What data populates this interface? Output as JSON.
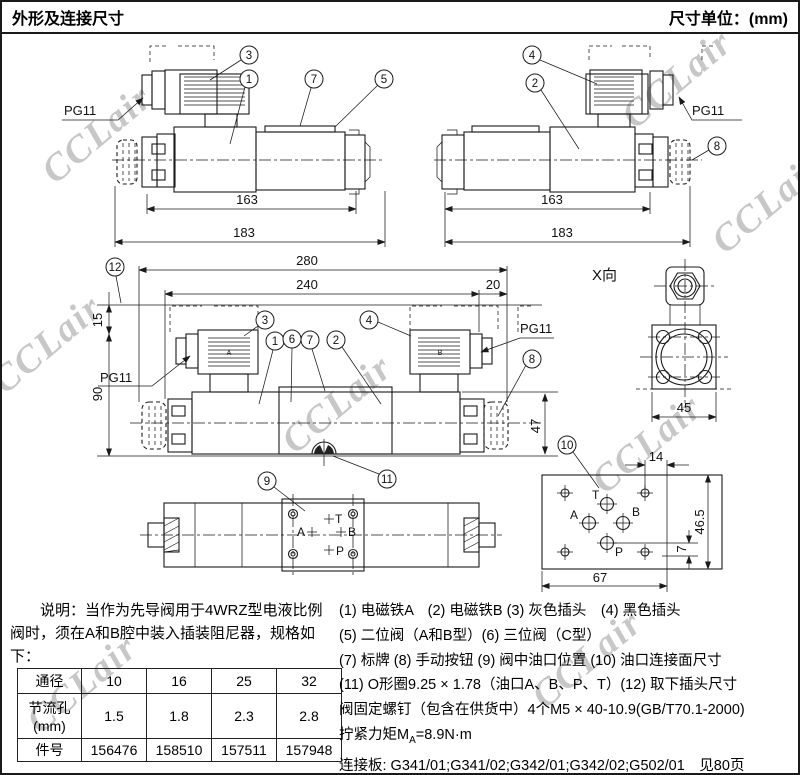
{
  "header": {
    "title": "外形及连接尺寸",
    "unit_label": "尺寸单位：(mm)"
  },
  "watermark": {
    "text": "CCLair"
  },
  "drawing": {
    "pg11": "PG11",
    "x_view_label": "X向",
    "callouts": {
      "c1": "1",
      "c2": "2",
      "c3": "3",
      "c4": "4",
      "c5": "5",
      "c6": "6",
      "c7": "7",
      "c8": "8",
      "c9": "9",
      "c10": "10",
      "c11": "11",
      "c12": "12"
    },
    "dims": {
      "d7": "7",
      "d14": "14",
      "d15": "15",
      "d20": "20",
      "d45": "45",
      "d46_5": "46.5",
      "d47": "47",
      "d67": "67",
      "d90": "90",
      "d163": "163",
      "d183": "183",
      "d240": "240",
      "d280": "280"
    },
    "ports": {
      "t": "T",
      "a": "A",
      "b": "B",
      "p": "P"
    },
    "coil_a": "A",
    "coil_b": "B"
  },
  "notes": {
    "text": "说明：当作为先导阀用于4WRZ型电液比例阀时，须在A和B腔中装入插装阻尼器，规格如下："
  },
  "table": {
    "rows": [
      {
        "label": "通径",
        "values": [
          "10",
          "16",
          "25",
          "32"
        ]
      },
      {
        "label": "节流孔\n(mm)",
        "values": [
          "1.5",
          "1.8",
          "2.3",
          "2.8"
        ]
      },
      {
        "label": "件号",
        "values": [
          "156476",
          "158510",
          "157511",
          "157948"
        ]
      }
    ]
  },
  "legend": {
    "line1": "(1) 电磁铁A　(2) 电磁铁B (3) 灰色插头　(4) 黑色插头",
    "line2": "(5) 二位阀（A和B型）(6) 三位阀（C型）",
    "line3": "(7) 标牌 (8) 手动按钮 (9) 阀中油口位置 (10) 油口连接面尺寸",
    "line4": "(11) O形圈9.25 × 1.78（油口A、B、P、T）(12) 取下插头尺寸",
    "line5": "阀固定螺钉（包含在供货中）4个M5 × 40-10.9(GB/T70.1-2000)",
    "torque_prefix": "拧紧力矩M",
    "torque_sub": "A",
    "torque_suffix": "=8.9N·m",
    "line7": "连接板: G341/01;G341/02;G342/01;G342/02;G502/01　见80页"
  }
}
